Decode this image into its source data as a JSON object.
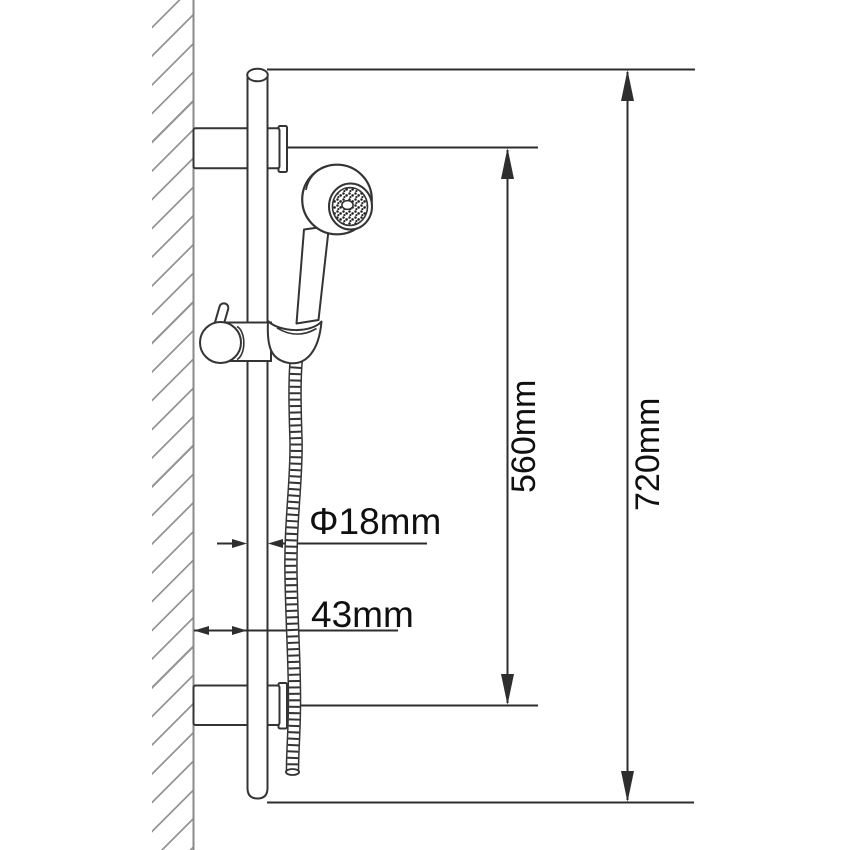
{
  "drawing": {
    "labels": {
      "bracket_spacing": "560mm",
      "overall_length": "720mm",
      "bar_diameter": "Φ18mm",
      "wall_offset": "43mm"
    },
    "values": {
      "bracket_spacing_mm": 560,
      "overall_length_mm": 720,
      "bar_diameter_mm": 18,
      "wall_offset_mm": 43
    },
    "parts": [
      "wall",
      "slide-bar",
      "wall-bracket-upper",
      "wall-bracket-lower",
      "slider-holder",
      "hand-shower-head",
      "shower-handle",
      "shower-hose"
    ],
    "colors": {
      "outline": "#343434",
      "dimension_line": "#2e2e2e",
      "text": "#101010",
      "wall_hatch": "#969696",
      "background": "#ffffff"
    }
  }
}
